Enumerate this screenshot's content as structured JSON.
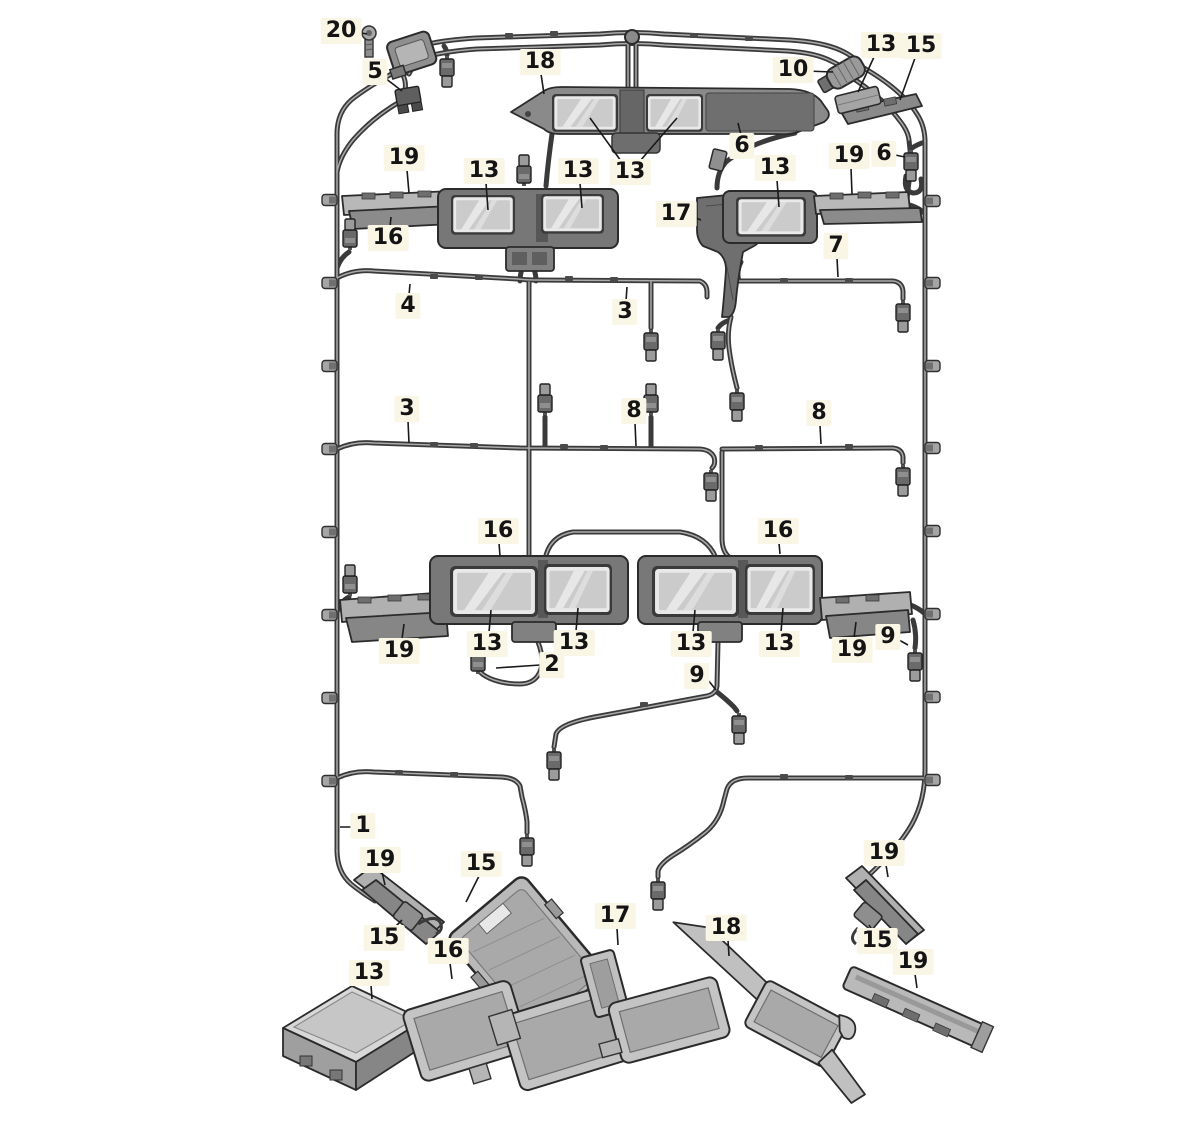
{
  "diagram": {
    "kind": "vehicle roof wiring-harness parts diagram",
    "background_color": "#ffffff",
    "wire_color": "#3a3a3a",
    "label_bg_color": "#faf6e6",
    "label_text_color": "#141414",
    "callouts": [
      {
        "text": "20",
        "x": 341,
        "y": 31,
        "leaders": [
          [
            356,
            32,
            367,
            34
          ]
        ]
      },
      {
        "text": "5",
        "x": 375,
        "y": 72,
        "leaders": [
          [
            385,
            78,
            402,
            91
          ]
        ]
      },
      {
        "text": "18",
        "x": 540,
        "y": 62,
        "leaders": [
          [
            541,
            74,
            544,
            94
          ]
        ]
      },
      {
        "text": "10",
        "x": 793,
        "y": 70,
        "leaders": [
          [
            806,
            71,
            833,
            72
          ]
        ]
      },
      {
        "text": "13",
        "x": 881,
        "y": 45,
        "leaders": [
          [
            874,
            57,
            858,
            92
          ]
        ]
      },
      {
        "text": "15",
        "x": 921,
        "y": 46,
        "leaders": [
          [
            915,
            58,
            900,
            100
          ]
        ]
      },
      {
        "text": "6",
        "x": 742,
        "y": 146,
        "leaders": [
          [
            741,
            135,
            738,
            123
          ]
        ]
      },
      {
        "text": "19",
        "x": 404,
        "y": 158,
        "leaders": [
          [
            407,
            170,
            409,
            193
          ]
        ]
      },
      {
        "text": "13",
        "x": 484,
        "y": 171,
        "leaders": [
          [
            486,
            183,
            488,
            210
          ]
        ]
      },
      {
        "text": "13",
        "x": 578,
        "y": 171,
        "leaders": [
          [
            580,
            183,
            582,
            208
          ]
        ]
      },
      {
        "text": "13",
        "x": 630,
        "y": 172,
        "leaders": [
          [
            621,
            161,
            590,
            118
          ],
          [
            640,
            161,
            677,
            118
          ]
        ]
      },
      {
        "text": "13",
        "x": 775,
        "y": 168,
        "leaders": [
          [
            777,
            180,
            779,
            207
          ]
        ]
      },
      {
        "text": "19",
        "x": 849,
        "y": 156,
        "leaders": [
          [
            851,
            168,
            852,
            194
          ]
        ]
      },
      {
        "text": "6",
        "x": 884,
        "y": 154,
        "leaders": [
          [
            895,
            155,
            905,
            157
          ]
        ]
      },
      {
        "text": "17",
        "x": 676,
        "y": 214,
        "leaders": [
          [
            688,
            215,
            701,
            220
          ]
        ]
      },
      {
        "text": "16",
        "x": 388,
        "y": 238,
        "leaders": [
          [
            390,
            227,
            391,
            217
          ]
        ]
      },
      {
        "text": "7",
        "x": 836,
        "y": 246,
        "leaders": [
          [
            837,
            258,
            838,
            277
          ]
        ]
      },
      {
        "text": "4",
        "x": 408,
        "y": 306,
        "leaders": [
          [
            409,
            295,
            410,
            284
          ]
        ]
      },
      {
        "text": "3",
        "x": 625,
        "y": 312,
        "leaders": [
          [
            626,
            301,
            627,
            287
          ]
        ]
      },
      {
        "text": "3",
        "x": 407,
        "y": 409,
        "leaders": [
          [
            408,
            421,
            409,
            443
          ]
        ]
      },
      {
        "text": "8",
        "x": 634,
        "y": 411,
        "leaders": [
          [
            635,
            423,
            636,
            446
          ]
        ]
      },
      {
        "text": "8",
        "x": 819,
        "y": 413,
        "leaders": [
          [
            820,
            425,
            821,
            444
          ]
        ]
      },
      {
        "text": "16",
        "x": 498,
        "y": 531,
        "leaders": [
          [
            499,
            543,
            500,
            556
          ]
        ]
      },
      {
        "text": "16",
        "x": 778,
        "y": 531,
        "leaders": [
          [
            779,
            543,
            780,
            554
          ]
        ]
      },
      {
        "text": "19",
        "x": 399,
        "y": 651,
        "leaders": [
          [
            402,
            639,
            404,
            624
          ]
        ]
      },
      {
        "text": "13",
        "x": 487,
        "y": 644,
        "leaders": [
          [
            489,
            632,
            491,
            610
          ]
        ]
      },
      {
        "text": "13",
        "x": 574,
        "y": 643,
        "leaders": [
          [
            576,
            631,
            578,
            608
          ]
        ]
      },
      {
        "text": "2",
        "x": 552,
        "y": 665,
        "leaders": [
          [
            540,
            665,
            496,
            668
          ]
        ]
      },
      {
        "text": "13",
        "x": 691,
        "y": 644,
        "leaders": [
          [
            693,
            632,
            695,
            610
          ]
        ]
      },
      {
        "text": "13",
        "x": 779,
        "y": 644,
        "leaders": [
          [
            781,
            632,
            783,
            608
          ]
        ]
      },
      {
        "text": "19",
        "x": 852,
        "y": 650,
        "leaders": [
          [
            854,
            638,
            856,
            622
          ]
        ]
      },
      {
        "text": "9",
        "x": 888,
        "y": 637,
        "leaders": [
          [
            899,
            640,
            908,
            645
          ]
        ]
      },
      {
        "text": "9",
        "x": 697,
        "y": 676,
        "leaders": [
          [
            708,
            680,
            716,
            690
          ]
        ]
      },
      {
        "text": "1",
        "x": 363,
        "y": 826,
        "leaders": [
          [
            357,
            827,
            340,
            827
          ]
        ]
      },
      {
        "text": "19",
        "x": 380,
        "y": 860,
        "leaders": [
          [
            382,
            872,
            385,
            885
          ]
        ]
      },
      {
        "text": "15",
        "x": 481,
        "y": 864,
        "leaders": [
          [
            479,
            876,
            466,
            902
          ]
        ]
      },
      {
        "text": "15",
        "x": 384,
        "y": 938,
        "leaders": [
          [
            392,
            930,
            402,
            920
          ]
        ]
      },
      {
        "text": "16",
        "x": 448,
        "y": 951,
        "leaders": [
          [
            450,
            963,
            452,
            979
          ]
        ]
      },
      {
        "text": "13",
        "x": 369,
        "y": 973,
        "leaders": [
          [
            371,
            985,
            372,
            999
          ]
        ]
      },
      {
        "text": "17",
        "x": 615,
        "y": 916,
        "leaders": [
          [
            617,
            928,
            618,
            945
          ]
        ]
      },
      {
        "text": "18",
        "x": 726,
        "y": 928,
        "leaders": [
          [
            728,
            940,
            729,
            956
          ]
        ]
      },
      {
        "text": "19",
        "x": 884,
        "y": 853,
        "leaders": [
          [
            886,
            865,
            888,
            877
          ]
        ]
      },
      {
        "text": "15",
        "x": 877,
        "y": 941,
        "leaders": [
          [
            874,
            933,
            869,
            925
          ]
        ]
      },
      {
        "text": "19",
        "x": 913,
        "y": 962,
        "leaders": [
          [
            915,
            974,
            917,
            988
          ]
        ]
      }
    ]
  }
}
